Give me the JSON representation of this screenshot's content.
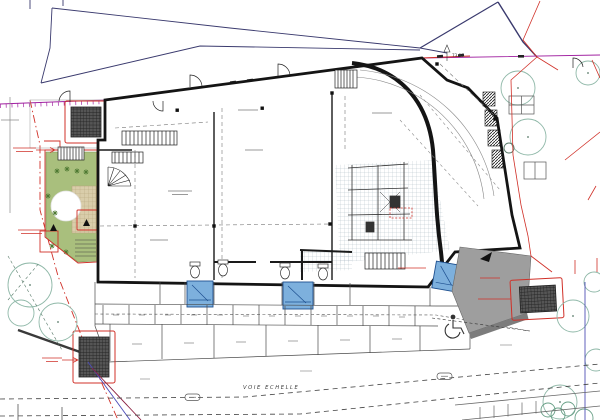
{
  "plan": {
    "street_label": "VOIE ECHELLE",
    "level_marker": "73.97"
  },
  "colors": {
    "wall_black": "#141414",
    "site_line_navy": "#3a3a6e",
    "boundary_purple": "#a020a0",
    "annotation_red": "#d03028",
    "garden_green": "#a9bf7d",
    "flower_green": "#4f7a33",
    "path_tan": "#d9cdaa",
    "tree_teal": "#8fb8a8",
    "fixture_blue": "#7db0dd",
    "fixture_blue_dark": "#1d4f8f",
    "ramp_gray": "#9e9e9e",
    "dark_hatch": "#4a4a4a",
    "street_blue_line": "#5050b5",
    "wine_line": "#8b2040"
  }
}
